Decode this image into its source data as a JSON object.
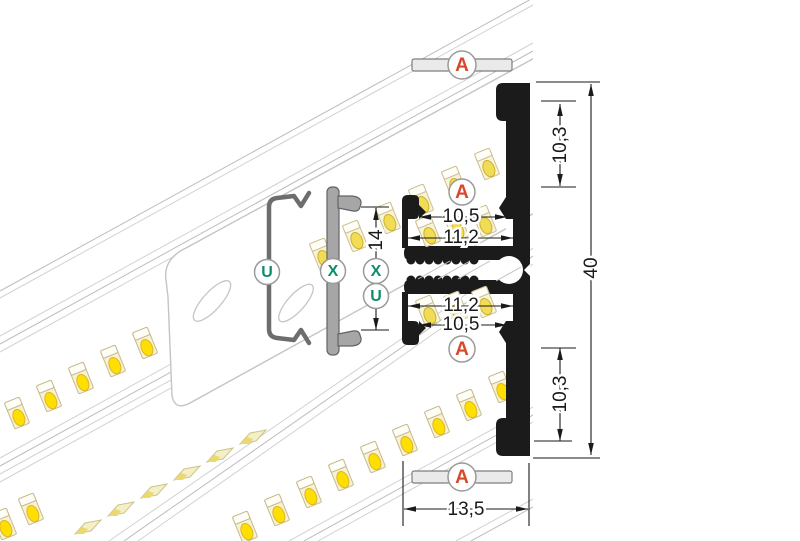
{
  "drawing": {
    "markers": {
      "cover_top": "A",
      "channel_top": "A",
      "channel_bottom": "A",
      "cover_bottom": "A",
      "clip_spring": "U",
      "clip_flat": "X",
      "dim_clip_x": "X",
      "dim_clip_u": "U"
    },
    "dimensions": {
      "top_pocket_depth": "10,3",
      "top_opening_width": "10,5",
      "top_inner_width": "11,2",
      "clip_span": "14",
      "bottom_inner_width": "11,2",
      "bottom_opening_width": "10,5",
      "bottom_pocket_depth": "10,3",
      "total_height": "40",
      "total_width": "13,5"
    },
    "colors": {
      "profile_black": "#1b1b1b",
      "marker_a_red": "#d9472b",
      "marker_ux_green": "#0e8c6d",
      "led_yellow": "#ffdf00",
      "dimension_ink": "#1a1a1a"
    }
  }
}
